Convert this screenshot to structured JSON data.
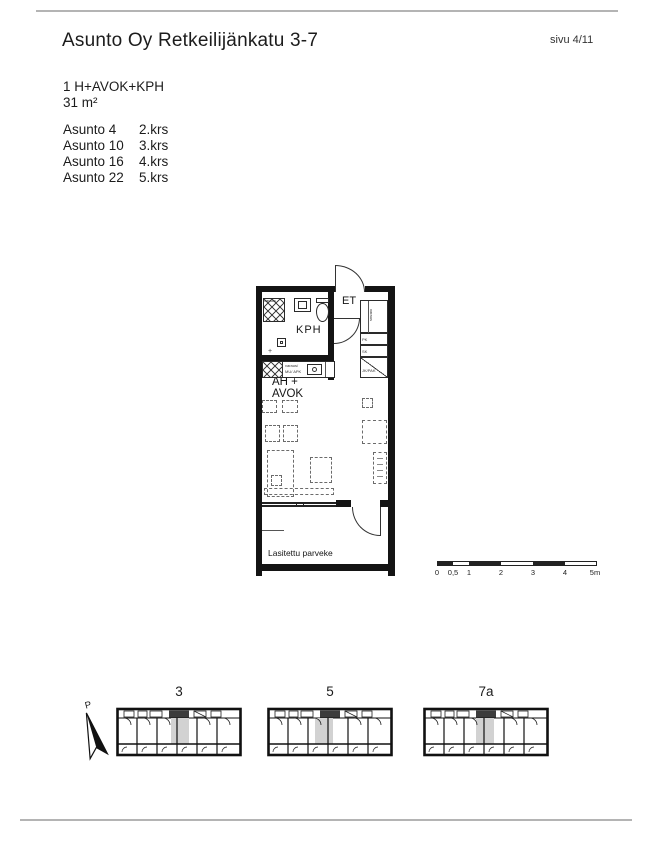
{
  "page": {
    "title": "Asunto Oy Retkeilijänkatu 3-7",
    "page_number": "sivu 4/11"
  },
  "apartment": {
    "type_label": "1 H+AVOK+KPH",
    "area_label": "31 m²",
    "units": [
      {
        "name": "Asunto 4",
        "floor": "2.krs"
      },
      {
        "name": "Asunto 10",
        "floor": "3.krs"
      },
      {
        "name": "Asunto 16",
        "floor": "4.krs"
      },
      {
        "name": "Asunto 22",
        "floor": "5.krs"
      }
    ]
  },
  "floor_plan": {
    "labels": {
      "entrance": "ET",
      "bathroom": "KPH",
      "living_line1": "AH +",
      "living_line2": "AVOK",
      "balcony": "Lasitettu parveke"
    },
    "cabinets": {
      "tall_rotated": "varaus",
      "top": "PK",
      "middle": "SK",
      "bottom": "JK/PAK"
    },
    "kitchen": {
      "small_text1": "varaus/",
      "small_text2": "MU/ APK"
    },
    "bath_closet_text": "varaus",
    "drain_symbol": "+"
  },
  "scale_bar": {
    "labels": [
      "0",
      "0,5",
      "1",
      "2",
      "3",
      "4",
      "5m"
    ]
  },
  "site_plan": {
    "north_label": "P",
    "buildings": [
      {
        "label": "3"
      },
      {
        "label": "5"
      },
      {
        "label": "7a"
      }
    ]
  }
}
